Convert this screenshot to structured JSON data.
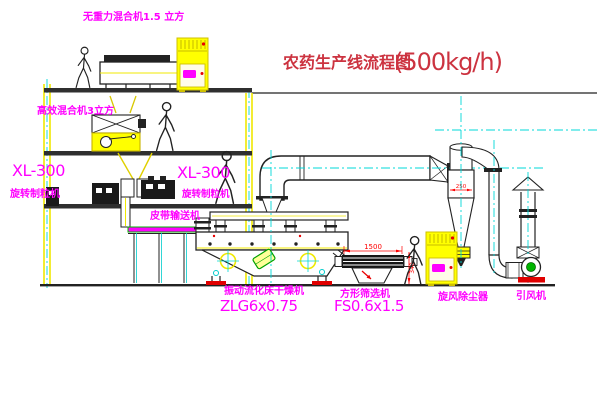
{
  "diagram": {
    "title": "农药生产线流程图",
    "capacity": "(500kg/h)"
  },
  "equipment_labels": {
    "top_mixer": "无重力混合机1.5 立方",
    "floor2_mixer": "高效混合机3立方",
    "granulator_left_model": "XL-300",
    "granulator_left_name": "旋转制粒机",
    "granulator_right_model": "XL-300",
    "granulator_right_name": "旋转制粒机",
    "belt_conveyor": "皮带输送机",
    "dryer_name": "振动流化床干燥机",
    "dryer_model": "ZLG6x0.75",
    "sieve_name": "方形筛选机",
    "sieve_model": "FS0.6x1.5",
    "cyclone": "旋风除尘器",
    "induced_draft_fan": "引风机"
  },
  "dimensions": {
    "sieve_length": "1500",
    "sieve_height": "340",
    "cyclone_width": "250"
  },
  "colors": {
    "label_magenta": "#ff00ff",
    "title_red": "#cc3340",
    "structure_yellow": "#f0e800",
    "centerline_cyan": "#00d8d8",
    "dimension_red": "#ff0000",
    "belt_green": "#00b400"
  }
}
